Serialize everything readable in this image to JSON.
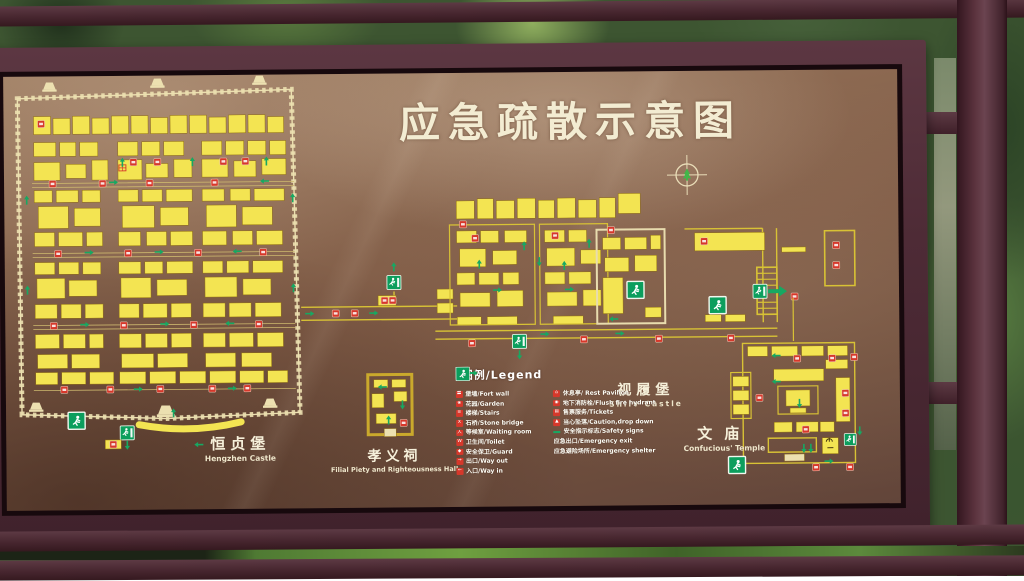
{
  "sign": {
    "title": "应急疏散示意图"
  },
  "legend": {
    "header": "图例/Legend",
    "left": [
      {
        "label": "堡墙/Fort wall",
        "glyph": "〓"
      },
      {
        "label": "花园/Garden",
        "glyph": "❀"
      },
      {
        "label": "楼梯/Stairs",
        "glyph": "≡"
      },
      {
        "label": "石桥/Stone bridge",
        "glyph": "X"
      },
      {
        "label": "等候室/Waiting room",
        "glyph": "人"
      },
      {
        "label": "卫生间/Toilet",
        "glyph": "W"
      },
      {
        "label": "安全保卫/Guard",
        "glyph": "◆"
      },
      {
        "label": "出口/Way out",
        "glyph": "→"
      },
      {
        "label": "入口/Way in",
        "glyph": "←"
      }
    ],
    "right": [
      {
        "label": "休息亭/ Rest Pavilion",
        "glyph": "⌂"
      },
      {
        "label": "地下消防栓/Flush fire hydrant",
        "glyph": "◉"
      },
      {
        "label": "售票服务/Tickets",
        "glyph": "▤"
      },
      {
        "label": "当心坠落/Caution,drop down",
        "glyph": "▲"
      },
      {
        "label": "安全指示标志/Safety signs",
        "glyph": ""
      },
      {
        "label": "应急出口/Emergency exit",
        "glyph": ""
      },
      {
        "label": "应急避险场所/Emergency shelter",
        "glyph": ""
      }
    ]
  },
  "places": {
    "hengzhen": {
      "zh": "恒贞堡",
      "en": "Hengzhen Castle"
    },
    "xiaoyi": {
      "zh": "孝义祠",
      "en": "Filial Piety and Righteousness Hall"
    },
    "shilv": {
      "zh": "视履堡",
      "en": "Shilv Castle"
    },
    "wenmiao": {
      "zh": "文庙",
      "en": "Confucious' Temple"
    }
  },
  "colors": {
    "panel_brown": "#7f5b46",
    "building_yellow": "#f3e452",
    "wall_cream": "#ece0b0",
    "red_icon": "#d6382b",
    "safety_green": "#0ea05e",
    "frame_maroon": "#4e2b36"
  }
}
